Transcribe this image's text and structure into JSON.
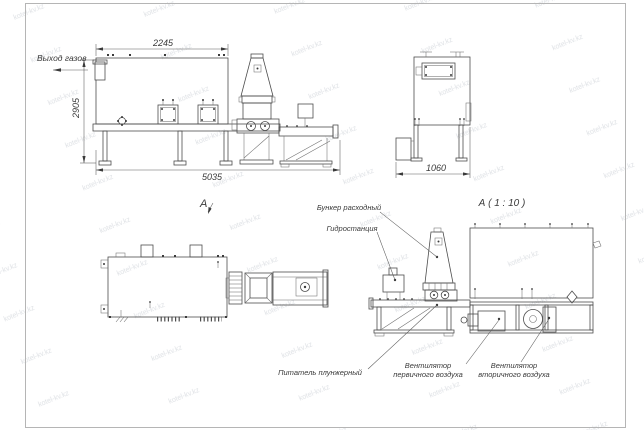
{
  "sheet": {
    "background_color": "#ffffff",
    "frame_color": "#b5b5b5",
    "ink_color": "#4d4d4d"
  },
  "watermark": {
    "text": "kotel-kv.kz",
    "color": "#a6aeb8"
  },
  "side_view": {
    "gas_outlet_label": "Выход газов",
    "dim_top_width": "2245",
    "dim_height": "2905",
    "dim_total_width": "5035"
  },
  "end_view": {
    "dim_width": "1060"
  },
  "plan_view": {
    "view_label": "А"
  },
  "detail_view": {
    "title": "А ( 1 : 10 )",
    "callout_hopper": "Бункер расходный",
    "callout_hydraulic": "Гидростанция",
    "callout_feeder": "Питатель плунжерный",
    "callout_fan_primary_line1": "Вентилятор",
    "callout_fan_primary_line2": "первичного воздуха",
    "callout_fan_secondary_line1": "Вентилятор",
    "callout_fan_secondary_line2": "вторичного воздуха"
  }
}
